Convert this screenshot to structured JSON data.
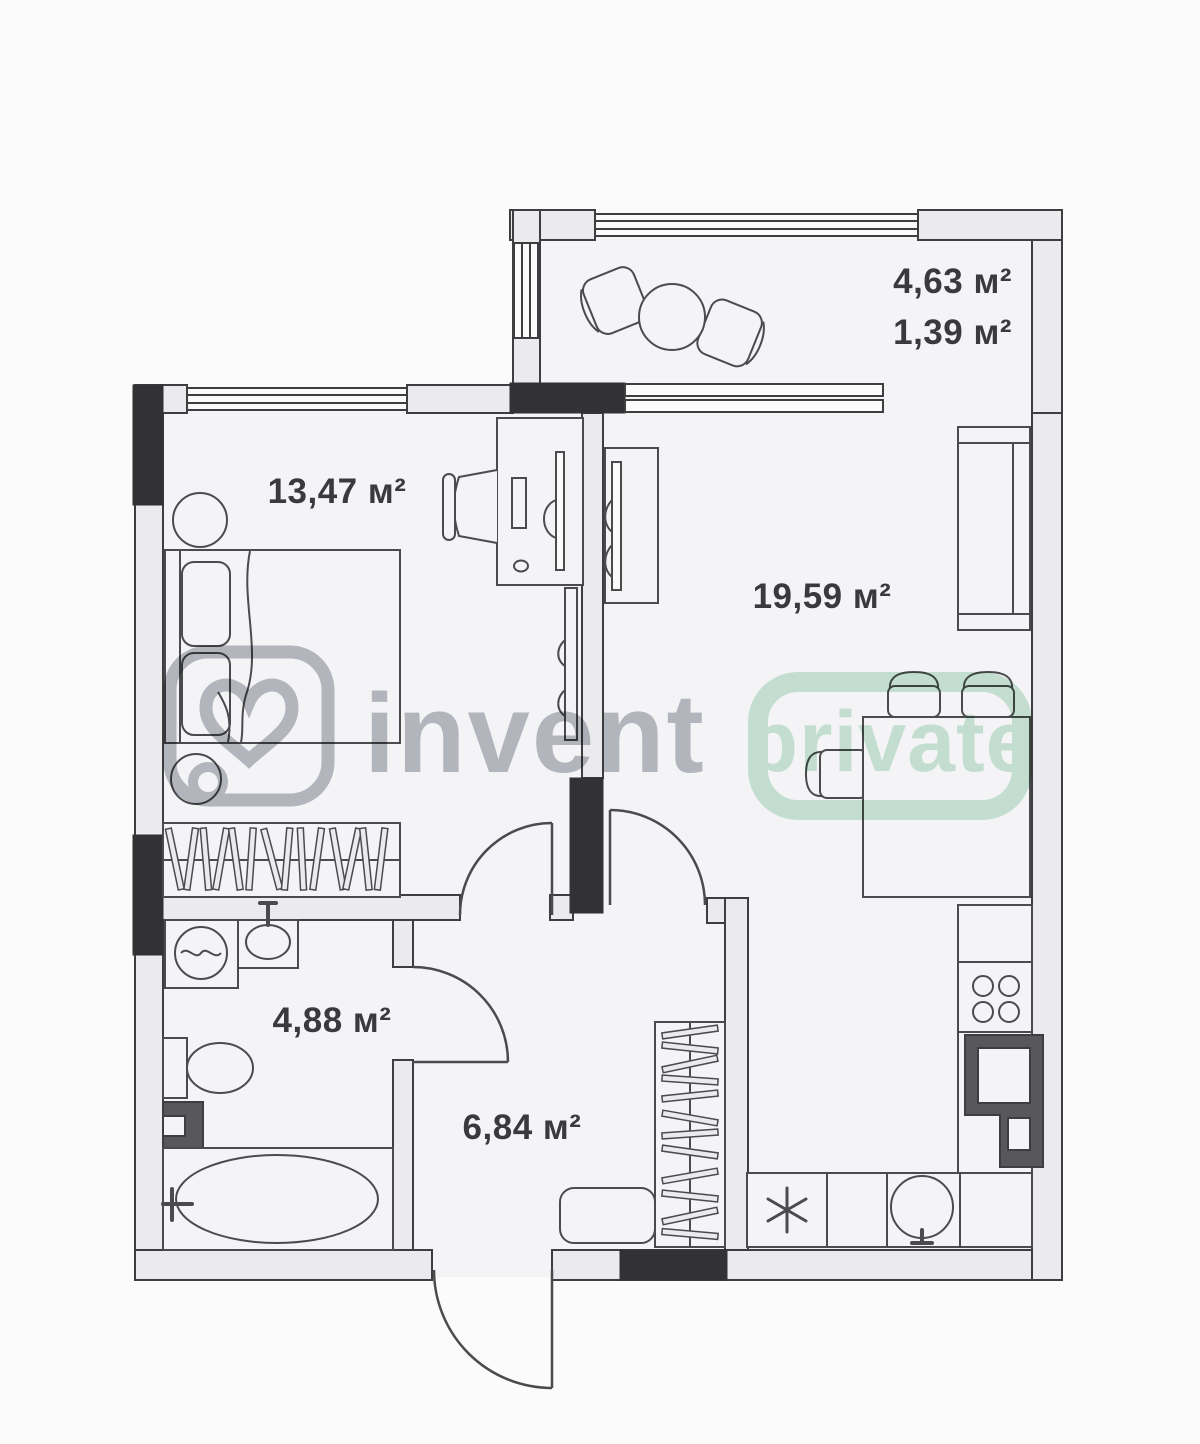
{
  "plan": {
    "type": "apartment-floor-plan",
    "colors": {
      "page_background": "#fbfbfc",
      "room_fill": "#f4f4f6",
      "wall_fill": "#ebebed",
      "wall_stroke": "#3e3e40",
      "structural_black": "#323234",
      "appliance_dark": "#58585a",
      "furniture_stroke": "#4b4b4d",
      "label_color": "#3a3a3c"
    },
    "rooms": [
      {
        "id": "balcony",
        "name": "balcony",
        "area_labels": [
          "4,63 м²",
          "1,39 м²"
        ],
        "furniture": [
          "round-table",
          "chair",
          "chair"
        ]
      },
      {
        "id": "bedroom",
        "name": "bedroom",
        "area_labels": [
          "13,47 м²"
        ],
        "furniture": [
          "double-bed",
          "pillows",
          "nightstand",
          "nightstand",
          "desk",
          "desk-chair",
          "monitor",
          "wall-tv",
          "wardrobe-with-hangers"
        ]
      },
      {
        "id": "living-kitchen",
        "name": "living room with kitchen",
        "area_labels": [
          "19,59 м²"
        ],
        "furniture": [
          "sofa",
          "tv-stand",
          "dining-table",
          "chairs",
          "kitchen-counter",
          "stove",
          "oven",
          "kitchen-sink",
          "dishwasher"
        ]
      },
      {
        "id": "bathroom",
        "name": "bathroom",
        "area_labels": [
          "4,88 м²"
        ],
        "furniture": [
          "washing-machine",
          "sink",
          "toilet",
          "towel-dryer",
          "bathtub"
        ]
      },
      {
        "id": "hallway",
        "name": "hallway",
        "area_labels": [
          "6,84 м²"
        ],
        "furniture": [
          "wardrobe-with-hangers",
          "bench",
          "entrance-door"
        ]
      }
    ]
  },
  "watermarks": {
    "brand_text": "invent",
    "badge_text": "private",
    "brand_color": "#b7bac0",
    "badge_color": "#c9e7d7"
  }
}
